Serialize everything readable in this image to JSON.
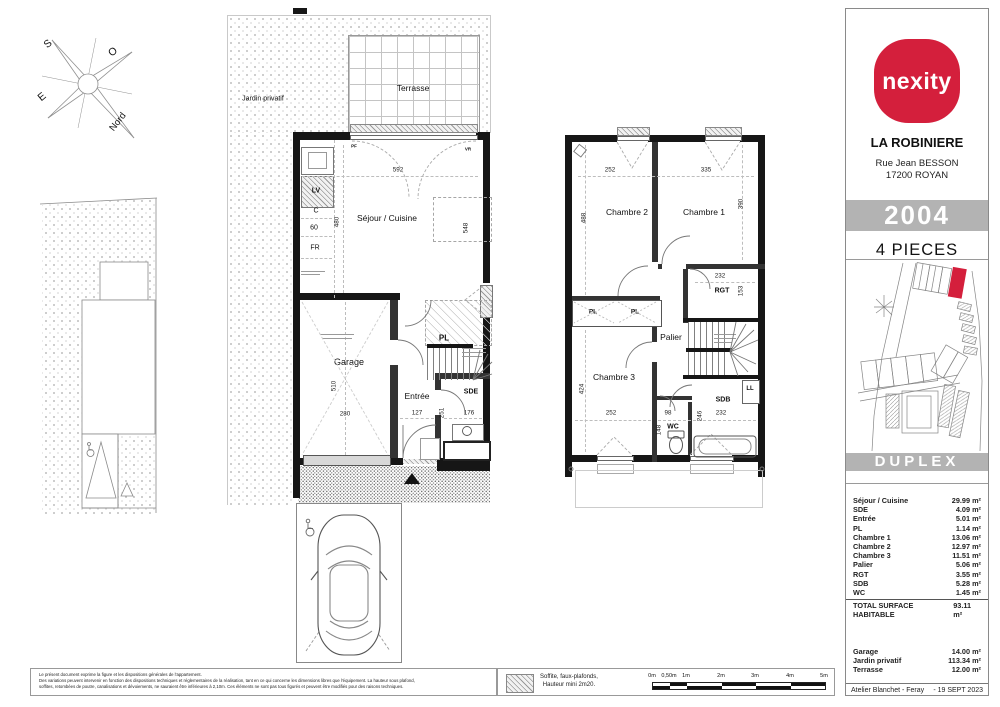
{
  "sidebar": {
    "brand": "nexity",
    "project": "LA ROBINIERE",
    "address_line1": "Rue Jean BESSON",
    "address_line2": "17200 ROYAN",
    "unit_number": "2004",
    "unit_type": "4 PIECES",
    "plan_type": "DUPLEX",
    "areas": [
      {
        "label": "Séjour / Cuisine",
        "value": "29.99 m²"
      },
      {
        "label": "SDE",
        "value": "4.09 m²"
      },
      {
        "label": "Entrée",
        "value": "5.01 m²"
      },
      {
        "label": "PL",
        "value": "1.14 m²"
      },
      {
        "label": "Chambre 1",
        "value": "13.06 m²"
      },
      {
        "label": "Chambre 2",
        "value": "12.97 m²"
      },
      {
        "label": "Chambre 3",
        "value": "11.51 m²"
      },
      {
        "label": "Palier",
        "value": "5.06 m²"
      },
      {
        "label": "RGT",
        "value": "3.55 m²"
      },
      {
        "label": "SDB",
        "value": "5.28 m²"
      },
      {
        "label": "WC",
        "value": "1.45 m²"
      }
    ],
    "total_label": "TOTAL SURFACE HABITABLE",
    "total_value": "93.11 m²",
    "annex_areas": [
      {
        "label": "Garage",
        "value": "14.00 m²"
      },
      {
        "label": "Jardin privatif",
        "value": "113.34 m²"
      },
      {
        "label": "Terrasse",
        "value": "12.00 m²"
      }
    ],
    "architect": "Atelier Blanchet - Feray",
    "date": "- 19 SEPT 2023",
    "colors": {
      "brand_red": "#d41f3c",
      "band_gray": "#b3b3b3"
    }
  },
  "compass": {
    "s": "S",
    "o": "O",
    "e": "E",
    "nord": "Nord"
  },
  "ground_floor": {
    "garden_label": "Jardin privatif",
    "terrace_label": "Terrasse",
    "living_label": "Séjour / Cuisine",
    "garage_label": "Garage",
    "entry_label": "Entrée",
    "sde_label": "SDE",
    "pl_label": "PL",
    "pf_label": "PF",
    "vr_label": "VR",
    "kitchen": {
      "lv": "LV",
      "c": "C",
      "w60": "60",
      "fr": "FR"
    },
    "dims": {
      "living_w": "592",
      "living_h": "480",
      "living_d": "548",
      "garage_h": "510",
      "garage_w": "280",
      "entry_w": "127",
      "entry_d": "251",
      "sde_w": "176"
    }
  },
  "upper_floor": {
    "bedroom1": "Chambre 1",
    "bedroom2": "Chambre 2",
    "bedroom3": "Chambre 3",
    "landing": "Palier",
    "rgt": "RGT",
    "sdb": "SDB",
    "wc": "WC",
    "pl1": "PL",
    "pl2": "PL",
    "ll": "LL",
    "dims": {
      "b2_w": "252",
      "b1_w": "335",
      "b2_h": "488",
      "b1_h": "390",
      "rgt_w": "232",
      "rgt_h": "153",
      "b3_h": "424",
      "b3_w": "252",
      "wc_w": "98",
      "wc_h": "148",
      "sdb_d": "246",
      "sdb_w": "232"
    }
  },
  "footer": {
    "legal_line1": "Le présent document exprime la figure et les dispositions générales de l'appartement.",
    "legal_line2": "Des variations peuvent intervenir en fonction des dispositions techniques et réglementaires de la réalisation, tant en ce qui concerne les dimensions libres que l'équipement. La hauteur sous plafond,",
    "legal_line3": "soffites, retombées de poutre, canalisations et dévoiements, ne sauraient être inférieures à 2,10m. Ces éléments ne sont pas tous figurés et peuvent être modifiés pour des raisons techniques.",
    "legend_line1": "Soffite, faux-plafonds,",
    "legend_line2": "Hauteur mini 2m20.",
    "scale_labels": [
      "0m",
      "0,50m",
      "1m",
      "2m",
      "3m",
      "4m",
      "5m"
    ]
  }
}
